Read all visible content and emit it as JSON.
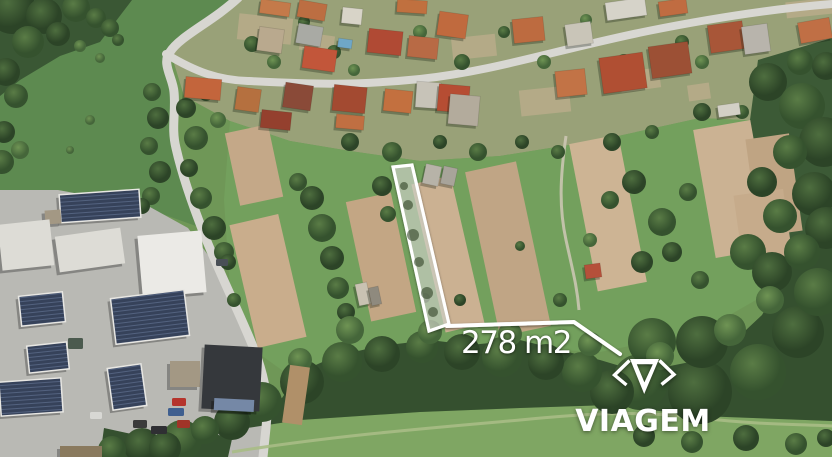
{
  "overlay": {
    "area_label": "278 m2",
    "brand_name": "VIAGEM",
    "accent_color": "#ffffff"
  },
  "scene": {
    "palette": {
      "base": "#6f9757",
      "house_stroke": "rgba(0,0,0,0.12)",
      "shadow": "rgba(18,28,14,0.30)",
      "building_types": {
        "white": "#dddcd6",
        "bright": "#ebeae6",
        "gray": "#a39884",
        "dark": "#35383c",
        "blue": "#7588a6",
        "brown": "#8a7a5e",
        "solar": "pattern"
      },
      "parcel_fill": "rgba(224,227,216,0.55)",
      "parcel_stroke": "#ffffff",
      "blob_fill": "rgba(55,75,45,0.6)",
      "patch_fill": "#bfae8d",
      "woodpile_fill": "#b09069"
    },
    "regions": [
      {
        "name": "meadow-upper-left",
        "points": "0,0 240,0 170,55 175,130 196,226 140,206 58,190 0,190",
        "fill": "#5d8a50"
      },
      {
        "name": "village-ground",
        "points": "170,50 240,0 832,0 832,62 788,122 700,118 600,140 500,156 420,161 350,151 290,141 230,121 184,96",
        "fill": "#99a178"
      },
      {
        "name": "garden-band",
        "points": "230,121 290,141 350,151 420,161 500,156 600,140 700,118 788,122 800,230 770,292 700,332 600,352 500,347 420,346 340,359 290,376 254,350 230,290 224,200",
        "fill": "#73a05d"
      },
      {
        "name": "bottom-meadow",
        "points": "228,457 234,430 300,420 420,412 520,408 610,405 700,416 832,421 832,457",
        "fill": "#7fa663"
      },
      {
        "name": "industrial-pavement",
        "points": "0,190 58,190 150,207 188,228 208,255 237,305 258,352 268,398 262,457 0,457",
        "fill": "#b9b9b4"
      },
      {
        "name": "forest",
        "points": "100,457 104,428 150,438 196,430 232,438 252,412 282,398 300,372 336,356 380,346 430,340 470,345 520,340 560,350 600,360 640,372 690,362 730,345 762,315 782,280 800,245 816,226 832,222 832,421 700,416 610,405 520,408 420,412 300,420 234,430 228,457",
        "fill": "#35502f"
      },
      {
        "name": "trees-right-edge",
        "points": "758,60 832,38 832,224 814,228 788,252 768,230 756,180 750,120",
        "fill": "#3c5a36"
      },
      {
        "name": "trees-top-left",
        "points": "0,0 132,0 100,42 60,56 20,80 0,96",
        "fill": "#3a5734"
      }
    ],
    "patches": [
      [
        238,
        16,
        54,
        26,
        6
      ],
      [
        300,
        34,
        34,
        18,
        8
      ],
      [
        452,
        36,
        44,
        22,
        -6
      ],
      [
        520,
        88,
        50,
        26,
        -6
      ],
      [
        620,
        70,
        40,
        20,
        -8
      ],
      [
        786,
        0,
        46,
        16,
        -6
      ],
      [
        688,
        84,
        22,
        16,
        -8
      ]
    ],
    "roads": [
      {
        "name": "road-north-south",
        "d": "M 238,-2 C 212,22 180,36 170,52 C 161,63 173,78 174,92 C 176,112 171,128 176,148 C 181,170 189,196 204,234 C 219,272 240,314 254,349 C 265,377 269,400 266,428 L 263,457",
        "w": 9,
        "c": "#d7d6d1"
      },
      {
        "name": "road-village",
        "d": "M 166,54 C 196,72 218,80 248,81 C 310,84 350,86 420,79 C 495,71 555,50 648,31 C 718,17 782,8 832,4",
        "w": 8,
        "c": "#d8d7d2"
      }
    ],
    "trails": [
      {
        "name": "garden-path",
        "d": "M 566,136 C 560,178 559,208 566,240 C 573,272 577,286 579,310",
        "w": 3,
        "c": "#cfc8b6",
        "o": 0.85
      },
      {
        "name": "bottom-trail",
        "d": "M 232,452 C 330,436 430,428 520,420 C 580,414 640,410 700,418 C 760,425 800,424 832,426",
        "w": 3,
        "c": "#a9bc85",
        "o": 0.9
      }
    ],
    "strips": [
      [
        232,
        128,
        44,
        74,
        -12,
        "#c4a888"
      ],
      [
        243,
        218,
        50,
        126,
        -13,
        "#c9ad8c"
      ],
      [
        358,
        196,
        46,
        122,
        -12,
        "#c3a684"
      ],
      [
        428,
        178,
        40,
        152,
        -13,
        "#cbb192"
      ],
      [
        482,
        165,
        52,
        168,
        -12,
        "#c0a585"
      ],
      [
        583,
        138,
        50,
        150,
        -11,
        "#cdb494"
      ],
      [
        704,
        124,
        58,
        130,
        -10,
        "#cbb293"
      ],
      [
        752,
        136,
        44,
        98,
        -8,
        "#bfa483"
      ],
      [
        738,
        192,
        50,
        68,
        -8,
        "#c6ab8b"
      ]
    ],
    "buildings": [
      [
        60,
        192,
        80,
        28,
        -4,
        "solar"
      ],
      [
        45,
        210,
        16,
        14,
        -4,
        "gray"
      ],
      [
        0,
        222,
        52,
        46,
        -6,
        "white"
      ],
      [
        57,
        232,
        66,
        36,
        -8,
        "white"
      ],
      [
        140,
        233,
        64,
        62,
        -5,
        "bright"
      ],
      [
        113,
        294,
        74,
        46,
        -7,
        "solar"
      ],
      [
        20,
        294,
        44,
        30,
        -6,
        "solar"
      ],
      [
        28,
        344,
        40,
        27,
        -6,
        "solar"
      ],
      [
        0,
        380,
        62,
        34,
        -4,
        "solar"
      ],
      [
        110,
        366,
        34,
        42,
        -8,
        "solar"
      ],
      [
        170,
        361,
        30,
        26,
        0,
        "gray"
      ],
      [
        203,
        346,
        58,
        64,
        3,
        "dark"
      ],
      [
        214,
        399,
        40,
        12,
        3,
        "blue"
      ],
      [
        60,
        446,
        42,
        11,
        0,
        "brown"
      ]
    ],
    "houses": [
      [
        260,
        1,
        30,
        14,
        8,
        "#c47a4a"
      ],
      [
        298,
        2,
        28,
        17,
        10,
        "#bc6e42"
      ],
      [
        342,
        8,
        20,
        16,
        6,
        "#d8d4c8"
      ],
      [
        397,
        0,
        30,
        13,
        4,
        "#c0703f"
      ],
      [
        258,
        28,
        25,
        24,
        8,
        "#b9a98e"
      ],
      [
        297,
        25,
        25,
        20,
        10,
        "#a9aaa4"
      ],
      [
        303,
        48,
        33,
        22,
        8,
        "#c2563a"
      ],
      [
        368,
        30,
        34,
        24,
        6,
        "#b04a34"
      ],
      [
        408,
        37,
        30,
        21,
        6,
        "#b86a45"
      ],
      [
        438,
        13,
        29,
        24,
        8,
        "#c06a3e"
      ],
      [
        513,
        18,
        31,
        24,
        -6,
        "#bd6b40"
      ],
      [
        566,
        23,
        26,
        22,
        -8,
        "#c9c5b8"
      ],
      [
        606,
        0,
        40,
        18,
        -8,
        "#d6d3c9"
      ],
      [
        659,
        0,
        28,
        15,
        -8,
        "#c06c41"
      ],
      [
        709,
        23,
        35,
        28,
        -8,
        "#a85638"
      ],
      [
        743,
        25,
        26,
        28,
        -8,
        "#b8b4ac"
      ],
      [
        799,
        20,
        32,
        21,
        -10,
        "#c06f45"
      ],
      [
        185,
        78,
        36,
        21,
        5,
        "#c3653c"
      ],
      [
        236,
        88,
        24,
        23,
        8,
        "#b5703f"
      ],
      [
        284,
        84,
        28,
        25,
        8,
        "#8a4a38"
      ],
      [
        333,
        86,
        33,
        26,
        6,
        "#a34a31"
      ],
      [
        384,
        90,
        28,
        22,
        6,
        "#c3703f"
      ],
      [
        416,
        82,
        24,
        26,
        4,
        "#c7c3b8"
      ],
      [
        438,
        85,
        31,
        27,
        5,
        "#b64d33"
      ],
      [
        601,
        55,
        44,
        36,
        -8,
        "#b04f33"
      ],
      [
        650,
        44,
        40,
        32,
        -8,
        "#9c5035"
      ],
      [
        556,
        70,
        30,
        26,
        -6,
        "#c27346"
      ],
      [
        449,
        95,
        30,
        30,
        5,
        "#b3ab9c"
      ],
      [
        261,
        111,
        30,
        18,
        6,
        "#94402e"
      ],
      [
        336,
        115,
        28,
        14,
        5,
        "#c06f42"
      ],
      [
        424,
        165,
        16,
        20,
        12,
        "#b7b3a8"
      ],
      [
        442,
        167,
        14,
        18,
        12,
        "#a8a49a"
      ],
      [
        585,
        264,
        16,
        14,
        -8,
        "#b5503a"
      ],
      [
        357,
        283,
        12,
        22,
        -12,
        "#c9c2b2"
      ],
      [
        370,
        287,
        10,
        18,
        -12,
        "#8f8a7e"
      ],
      [
        338,
        39,
        14,
        9,
        8,
        "#6fa7c7"
      ],
      [
        718,
        104,
        22,
        12,
        -8,
        "#d3d0c6"
      ]
    ],
    "cars": [
      [
        172,
        398,
        14,
        8,
        "#b5342c"
      ],
      [
        168,
        408,
        16,
        8,
        "#3f5f8f"
      ],
      [
        133,
        420,
        14,
        8,
        "#3a3a3a"
      ],
      [
        151,
        426,
        16,
        8,
        "#2f2f33"
      ],
      [
        90,
        412,
        12,
        7,
        "#d8d8d4"
      ],
      [
        177,
        420,
        13,
        8,
        "#a03428"
      ],
      [
        68,
        338,
        15,
        11,
        "#4b5a4e"
      ],
      [
        216,
        259,
        12,
        7,
        "#494f56"
      ]
    ],
    "woodpile": [
      286,
      366,
      20,
      58,
      8
    ],
    "trees": [
      [
        12,
        10,
        24,
        "a"
      ],
      [
        44,
        16,
        18,
        "a"
      ],
      [
        76,
        8,
        14,
        "b"
      ],
      [
        28,
        42,
        16,
        "b"
      ],
      [
        58,
        34,
        12,
        "a"
      ],
      [
        96,
        18,
        10,
        "b"
      ],
      [
        6,
        72,
        14,
        "a"
      ],
      [
        16,
        96,
        12,
        "b"
      ],
      [
        4,
        132,
        11,
        "a"
      ],
      [
        2,
        162,
        12,
        "b"
      ],
      [
        20,
        150,
        9,
        "c"
      ],
      [
        110,
        28,
        9,
        "b"
      ],
      [
        80,
        46,
        6,
        "c"
      ],
      [
        100,
        58,
        5,
        "c"
      ],
      [
        118,
        40,
        6,
        "b"
      ],
      [
        90,
        120,
        5,
        "c"
      ],
      [
        70,
        150,
        4,
        "c"
      ],
      [
        152,
        92,
        9,
        "b"
      ],
      [
        158,
        118,
        11,
        "a"
      ],
      [
        149,
        146,
        9,
        "b"
      ],
      [
        160,
        172,
        11,
        "a"
      ],
      [
        151,
        196,
        9,
        "b"
      ],
      [
        142,
        206,
        8,
        "a"
      ],
      [
        186,
        108,
        10,
        "a"
      ],
      [
        196,
        138,
        12,
        "b"
      ],
      [
        189,
        168,
        9,
        "a"
      ],
      [
        201,
        198,
        11,
        "b"
      ],
      [
        214,
        228,
        12,
        "a"
      ],
      [
        206,
        94,
        7,
        "b"
      ],
      [
        224,
        252,
        10,
        "b"
      ],
      [
        218,
        120,
        8,
        "c"
      ],
      [
        252,
        44,
        8,
        "b"
      ],
      [
        274,
        62,
        7,
        "c"
      ],
      [
        304,
        22,
        6,
        "b"
      ],
      [
        334,
        52,
        7,
        "b"
      ],
      [
        420,
        32,
        7,
        "c"
      ],
      [
        462,
        62,
        8,
        "b"
      ],
      [
        504,
        32,
        6,
        "b"
      ],
      [
        544,
        62,
        7,
        "c"
      ],
      [
        624,
        62,
        8,
        "b"
      ],
      [
        682,
        42,
        7,
        "b"
      ],
      [
        702,
        62,
        7,
        "c"
      ],
      [
        586,
        20,
        6,
        "c"
      ],
      [
        354,
        70,
        6,
        "c"
      ],
      [
        350,
        142,
        9,
        "a"
      ],
      [
        392,
        152,
        10,
        "b"
      ],
      [
        440,
        142,
        7,
        "a"
      ],
      [
        478,
        152,
        9,
        "b"
      ],
      [
        522,
        142,
        7,
        "a"
      ],
      [
        558,
        152,
        7,
        "b"
      ],
      [
        612,
        142,
        9,
        "a"
      ],
      [
        652,
        132,
        7,
        "b"
      ],
      [
        702,
        112,
        9,
        "a"
      ],
      [
        742,
        112,
        7,
        "b"
      ],
      [
        312,
        198,
        12,
        "a"
      ],
      [
        322,
        228,
        14,
        "b"
      ],
      [
        332,
        258,
        12,
        "a"
      ],
      [
        338,
        288,
        11,
        "b"
      ],
      [
        346,
        312,
        9,
        "a"
      ],
      [
        298,
        182,
        9,
        "b"
      ],
      [
        228,
        262,
        8,
        "a"
      ],
      [
        234,
        300,
        7,
        "b"
      ],
      [
        382,
        186,
        10,
        "a"
      ],
      [
        388,
        214,
        8,
        "b"
      ],
      [
        425,
        298,
        5,
        "b"
      ],
      [
        460,
        300,
        6,
        "a"
      ],
      [
        520,
        246,
        5,
        "b"
      ],
      [
        610,
        200,
        9,
        "b"
      ],
      [
        634,
        182,
        12,
        "a"
      ],
      [
        662,
        222,
        14,
        "b"
      ],
      [
        642,
        262,
        11,
        "a"
      ],
      [
        688,
        192,
        9,
        "b"
      ],
      [
        672,
        252,
        10,
        "a"
      ],
      [
        700,
        280,
        9,
        "b"
      ],
      [
        590,
        240,
        7,
        "c"
      ],
      [
        560,
        300,
        7,
        "b"
      ],
      [
        768,
        82,
        19,
        "a"
      ],
      [
        802,
        106,
        23,
        "b"
      ],
      [
        824,
        142,
        25,
        "a"
      ],
      [
        790,
        152,
        17,
        "b"
      ],
      [
        814,
        194,
        22,
        "a"
      ],
      [
        780,
        216,
        17,
        "b"
      ],
      [
        826,
        228,
        21,
        "a"
      ],
      [
        800,
        62,
        13,
        "b"
      ],
      [
        762,
        182,
        15,
        "a"
      ],
      [
        748,
        252,
        18,
        "b"
      ],
      [
        772,
        272,
        20,
        "a"
      ],
      [
        802,
        252,
        18,
        "b"
      ],
      [
        826,
        66,
        14,
        "a"
      ],
      [
        640,
        382,
        28,
        "b"
      ],
      [
        700,
        392,
        32,
        "a"
      ],
      [
        758,
        372,
        28,
        "b"
      ],
      [
        798,
        332,
        26,
        "a"
      ],
      [
        818,
        292,
        24,
        "b"
      ],
      [
        702,
        342,
        26,
        "a"
      ],
      [
        652,
        342,
        24,
        "b"
      ],
      [
        612,
        392,
        22,
        "a"
      ],
      [
        582,
        372,
        20,
        "b"
      ],
      [
        546,
        362,
        18,
        "a"
      ],
      [
        502,
        357,
        20,
        "b"
      ],
      [
        462,
        352,
        18,
        "a"
      ],
      [
        422,
        347,
        16,
        "b"
      ],
      [
        382,
        354,
        18,
        "a"
      ],
      [
        342,
        362,
        20,
        "b"
      ],
      [
        302,
        382,
        22,
        "a"
      ],
      [
        262,
        402,
        20,
        "b"
      ],
      [
        232,
        422,
        18,
        "a"
      ],
      [
        182,
        440,
        20,
        "b"
      ],
      [
        142,
        446,
        18,
        "a"
      ],
      [
        112,
        450,
        14,
        "b"
      ],
      [
        350,
        330,
        14,
        "c"
      ],
      [
        430,
        332,
        12,
        "c"
      ],
      [
        510,
        334,
        12,
        "c"
      ],
      [
        590,
        344,
        12,
        "c"
      ],
      [
        660,
        356,
        14,
        "c"
      ],
      [
        730,
        330,
        16,
        "c"
      ],
      [
        770,
        300,
        14,
        "c"
      ],
      [
        240,
        390,
        12,
        "c"
      ],
      [
        300,
        360,
        12,
        "c"
      ],
      [
        205,
        430,
        14,
        "b"
      ],
      [
        165,
        448,
        16,
        "a"
      ],
      [
        644,
        436,
        11,
        "a"
      ],
      [
        692,
        442,
        11,
        "b"
      ],
      [
        746,
        438,
        13,
        "a"
      ],
      [
        796,
        444,
        11,
        "b"
      ],
      [
        826,
        438,
        9,
        "a"
      ]
    ],
    "parcel": {
      "points": "393,167 412,165 449,324 429,331",
      "blobs": [
        [
          404,
          186,
          4
        ],
        [
          408,
          205,
          5
        ],
        [
          413,
          235,
          6
        ],
        [
          419,
          262,
          5
        ],
        [
          427,
          293,
          6
        ],
        [
          433,
          312,
          5
        ]
      ],
      "stroke_width": 3.2
    },
    "leader": {
      "points": "447,326 574,322 620,354",
      "stroke_width": 4
    }
  }
}
